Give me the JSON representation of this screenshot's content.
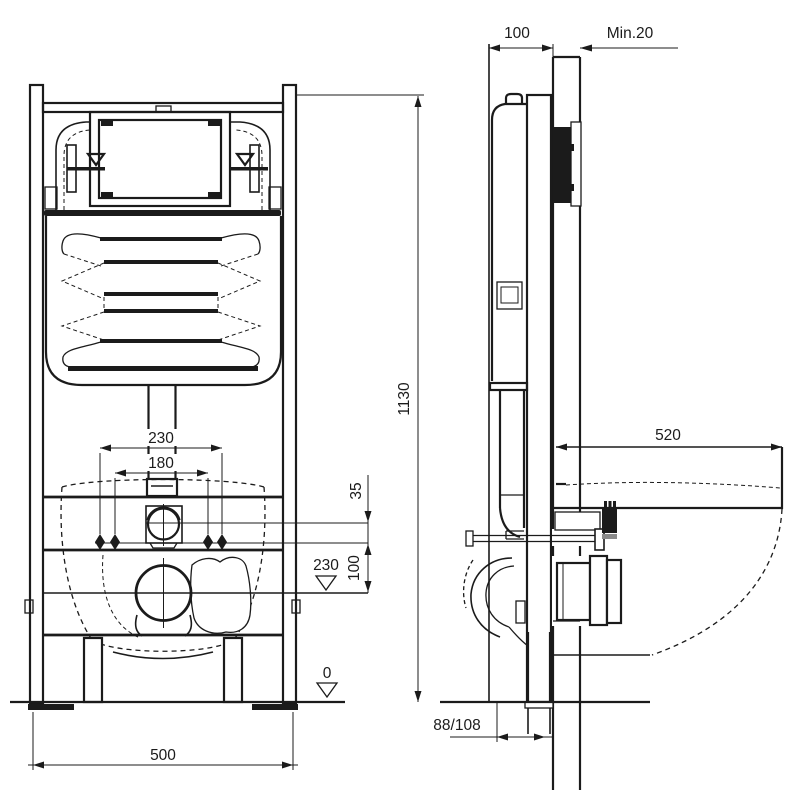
{
  "drawing": {
    "type": "wc-concealed-cistern-frame-installation-dimensions",
    "colors": {
      "line": "#1b1b1b",
      "background": "#ffffff",
      "flush_plate": "#000000",
      "washer": "#8a8a8a"
    },
    "labels": {
      "frame_depth": "100",
      "wall_min": "Min.20",
      "frame_height": "1130",
      "bolt_outer": "230",
      "bolt_inner": "180",
      "supply_gap": "35",
      "bolt_outlet_gap": "100",
      "outlet_height": "230",
      "floor_level": "0",
      "frame_width": "500",
      "pan_depth": "520",
      "drain_offset": "88/108"
    }
  }
}
